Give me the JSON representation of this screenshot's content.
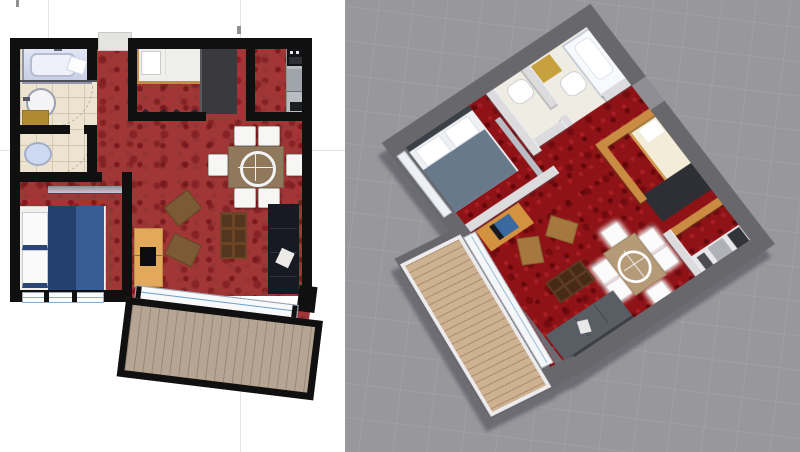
{
  "view": {
    "type": "apartment-floor-plan",
    "layout": "2D plan beside 3D overhead view",
    "left_panel": {
      "name": "2D floor plan",
      "background_color": "#ffffff",
      "wall_color": "#101010",
      "carpet_color": "#a03636",
      "bathroom_tile_color": "#ece4d1",
      "balcony_deck_color": "#b6a593",
      "rooms": [
        {
          "name": "bathroom",
          "fixtures": [
            "bathtub",
            "sink",
            "gold cabinet",
            "door arc"
          ]
        },
        {
          "name": "wc",
          "fixtures": [
            "toilet",
            "door arc"
          ]
        },
        {
          "name": "bedroom",
          "fixtures": [
            "double bed with navy duvet",
            "two striped pillows",
            "wall shelf",
            "window"
          ]
        },
        {
          "name": "entry closet room",
          "fixtures": [
            "single bed with wood frame",
            "dark wardrobe",
            "coat hooks"
          ]
        },
        {
          "name": "kitchen nook",
          "fixtures": [
            "counter",
            "oven",
            "appliance panel"
          ]
        },
        {
          "name": "living dining room",
          "fixtures": [
            "dining table with turntable ring",
            "6 white chairs",
            "dark sofa with pillow",
            "coffee table",
            "tv stand with tv",
            "2 brown ottomans"
          ]
        },
        {
          "name": "balcony",
          "fixtures": [
            "wood plank deck",
            "sliding glass door"
          ]
        }
      ],
      "dining_chair_count": 6
    },
    "right_panel": {
      "name": "3D overhead view",
      "background_color": "#97979c",
      "outer_wall_color": "#67676c",
      "inner_wall_color": "#dcdcde",
      "wood_wall_color": "#c98c42",
      "carpet_color": "#8e1216",
      "balcony_deck_color": "#cdb190",
      "rotation_deg": 53,
      "rooms_visible": [
        "bathroom",
        "wc",
        "bedroom",
        "entry closet room",
        "kitchen nook",
        "living dining room",
        "balcony"
      ]
    }
  }
}
